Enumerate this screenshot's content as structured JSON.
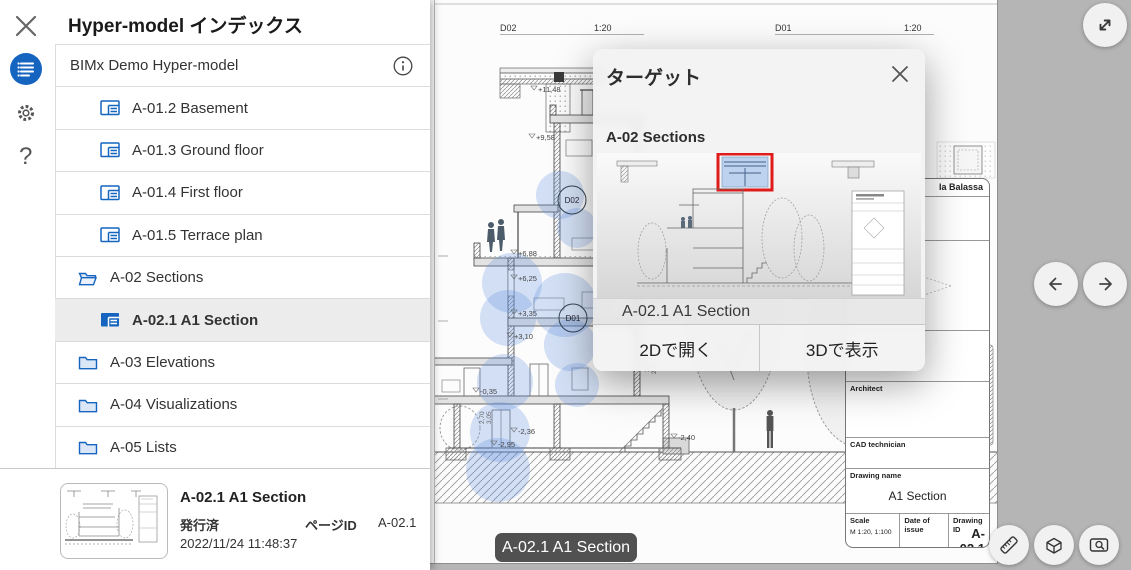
{
  "sidebar": {
    "title": "Hyper-model インデックス",
    "root": {
      "label": "BIMx Demo Hyper-model"
    },
    "items": [
      {
        "label": "A-01.2 Basement"
      },
      {
        "label": "A-01.3 Ground floor"
      },
      {
        "label": "A-01.4 First floor"
      },
      {
        "label": "A-01.5 Terrace plan"
      },
      {
        "label": "A-02 Sections"
      },
      {
        "label": "A-02.1 A1 Section"
      },
      {
        "label": "A-03 Elevations"
      },
      {
        "label": "A-04 Visualizations"
      },
      {
        "label": "A-05 Lists"
      }
    ],
    "detail": {
      "title": "A-02.1 A1 Section",
      "status": "発行済",
      "page_id_label": "ページID",
      "page_id": "A-02.1",
      "timestamp": "2022/11/24 11:48:37"
    },
    "help_glyph": "?"
  },
  "dialog": {
    "title": "ターゲット",
    "group": "A-02 Sections",
    "caption": "A-02.1 A1 Section",
    "open_2d": "2Dで開く",
    "show_3d": "3Dで表示"
  },
  "viewer": {
    "badge": "A-02.1 A1 Section",
    "d02_label": "D02",
    "d02_scale": "1:20",
    "d01_label": "D01",
    "d01_scale": "1:20",
    "callout_d02": "D02",
    "callout_d01": "D01",
    "elevations": [
      "+11,48",
      "+9,58",
      "+6,88",
      "+6,25",
      "+3,35",
      "+3,10",
      "-0,35",
      "-2,36",
      "-2,40",
      "-2,95"
    ],
    "dims": [
      "2,40",
      "2,90",
      "3,33",
      "3,50",
      "2,80",
      "2,70",
      "3,05"
    ],
    "title_block": {
      "project": "la Balassa",
      "architect_label": "Architect",
      "cad_label": "CAD technician",
      "name_label": "Drawing name",
      "name": "A1 Section",
      "scale_label": "Scale",
      "scale": "M 1:20, 1:100",
      "date_label": "Date of issue",
      "id_label": "Drawing ID",
      "id": "A-02.1"
    }
  },
  "colors": {
    "accent": "#1565c0",
    "highlight_red": "#e01b1b",
    "hotspot_blue": "rgba(96,145,222,0.27)",
    "stage_bg": "#b5b5b5"
  }
}
